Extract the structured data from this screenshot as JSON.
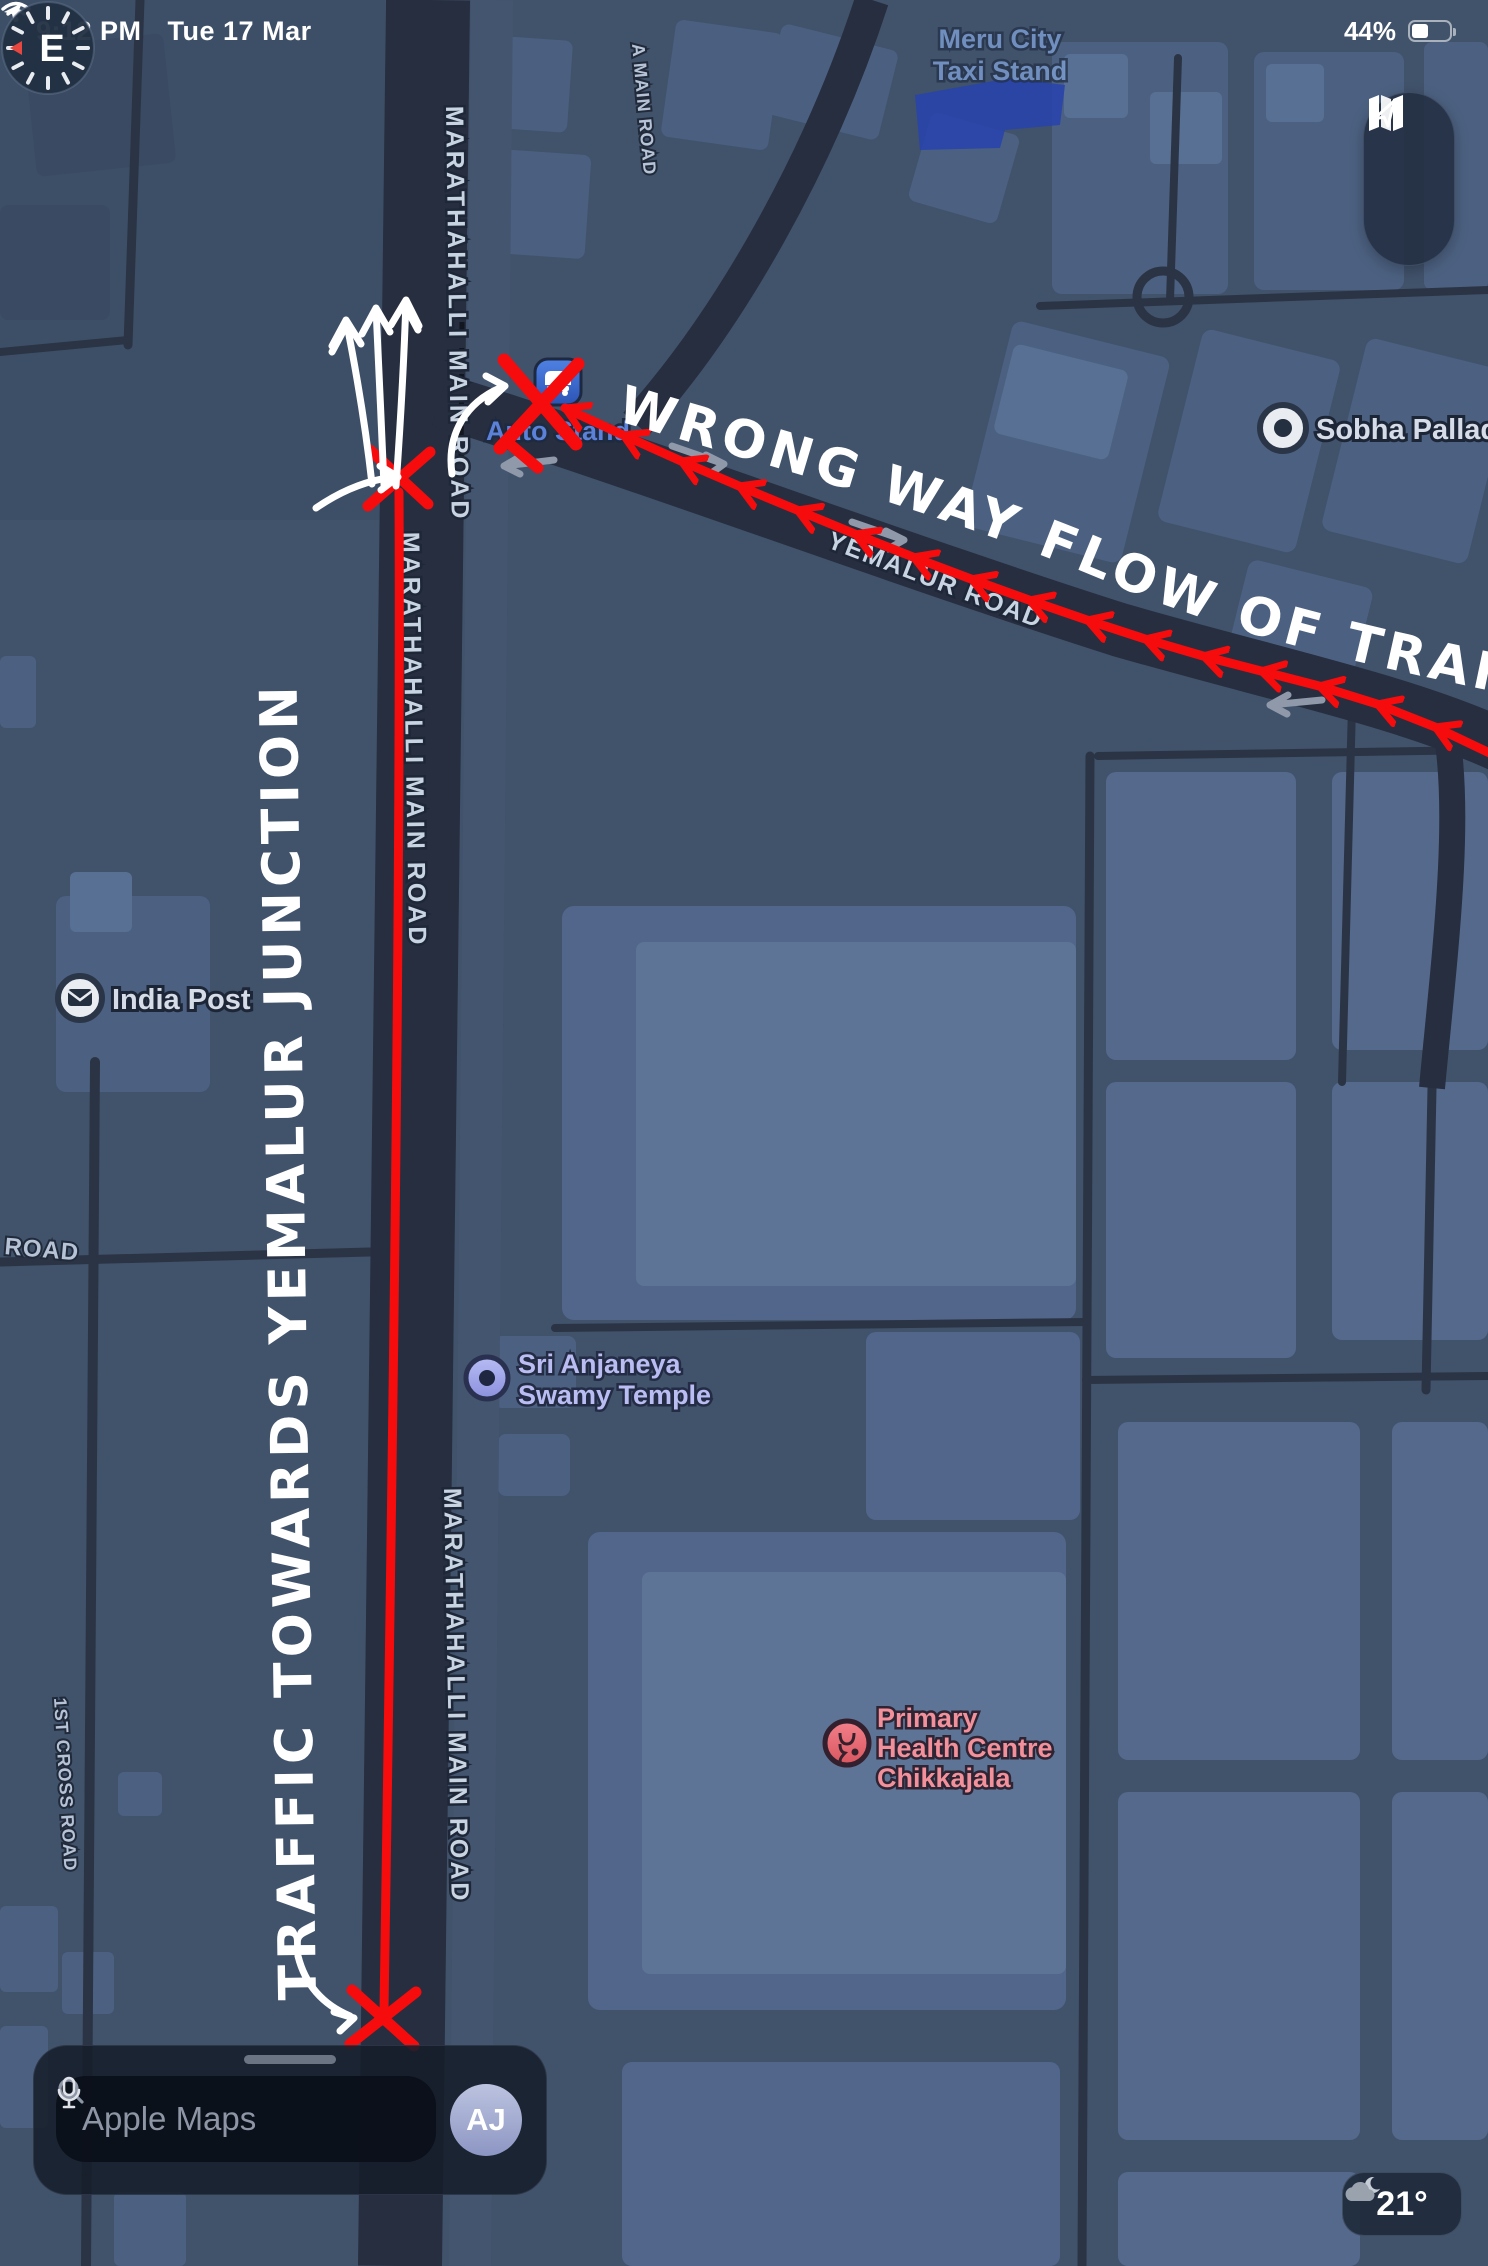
{
  "status_bar": {
    "time": "9:12 PM",
    "date": "Tue 17 Mar",
    "battery_percent": "44%"
  },
  "map_controls": {
    "compass_heading": "E"
  },
  "map_labels": {
    "meru_city_taxi_stand": {
      "line1": "Meru City",
      "line2": "Taxi Stand"
    },
    "auto_stand": "Auto Stand",
    "sobha_palladian": "Sobha Palladian",
    "yemalur_road": "YEMALUR ROAD",
    "a_main_road": "A MAIN ROAD",
    "marathahalli_main_road": "MARATHAHALLI MAIN ROAD",
    "india_post": "India Post",
    "sri_anjaneya": {
      "line1": "Sri Anjaneya",
      "line2": "Swamy Temple"
    },
    "primary_health": {
      "line1": "Primary",
      "line2": "Health Centre",
      "line3": "Chikkajala"
    },
    "first_cross_road": "1ST CROSS ROAD",
    "road_partial": "ROAD"
  },
  "annotations": {
    "wrong_way": "WRONG WAY FLOW OF TRAFFIC",
    "traffic_towards": "TRAFFIC TOWARDS YEMALUR JUNCTION"
  },
  "search_bar": {
    "placeholder": "Apple Maps",
    "avatar_initials": "AJ"
  },
  "weather": {
    "temperature": "21°"
  },
  "colors": {
    "annotation_red": "#f60c0c",
    "annotation_white": "#ffffff",
    "map_background": "#41526b",
    "road_dark": "#262e3f",
    "building": "#4b6080",
    "poi_pink": "#f2919b",
    "poi_lavender": "#babdf2",
    "taxi_stand_blue": "#2743ae"
  }
}
